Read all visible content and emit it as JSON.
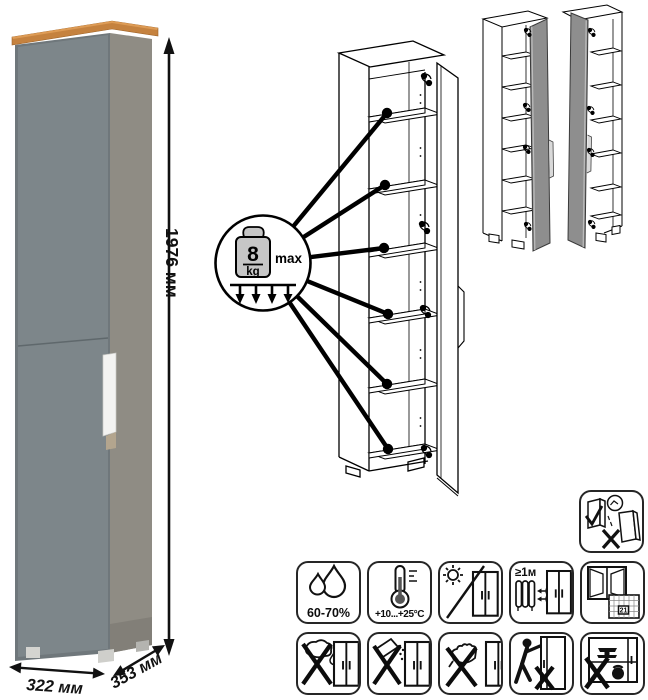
{
  "product_diagram": {
    "dimensions": {
      "height": "1976 мм",
      "width": "322 мм",
      "depth": "353 мм"
    },
    "shelf_load": {
      "value": "8",
      "unit": "kg",
      "qualifier": "max"
    },
    "care_instructions": {
      "humidity_range": "60-70%",
      "temperature_range": "+10...+25°C",
      "min_distance_from_heat": "≥1м",
      "calendar_day": "21"
    },
    "colors": {
      "front_door": "#7d868a",
      "side_panel": "#8f8c84",
      "top_trim": "#c5823f",
      "handle": "#f3f3f1",
      "variant_door_fill": "#8e8e8e",
      "line_art": "#000000"
    }
  }
}
